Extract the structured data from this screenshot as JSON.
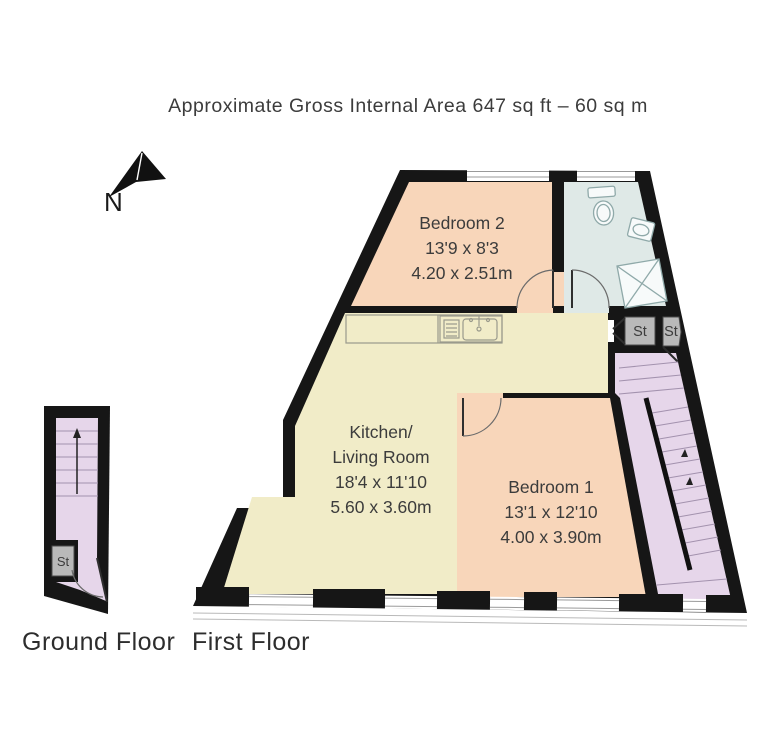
{
  "title": "Approximate Gross Internal Area 647 sq ft – 60 sq m",
  "compass": {
    "label": "N"
  },
  "floor_labels": {
    "ground": "Ground Floor",
    "first": "First Floor"
  },
  "rooms": {
    "bedroom2": {
      "name": "Bedroom 2",
      "dims_imperial": "13'9 x 8'3",
      "dims_metric": "4.20 x 2.51m"
    },
    "kitchen_living": {
      "name_line1": "Kitchen/",
      "name_line2": "Living Room",
      "dims_imperial": "18'4 x 11'10",
      "dims_metric": "5.60 x 3.60m"
    },
    "bedroom1": {
      "name": "Bedroom 1",
      "dims_imperial": "13'1 x 12'10",
      "dims_metric": "4.00 x 3.90m"
    }
  },
  "storage": {
    "abbrev": "St"
  },
  "colors": {
    "wall": "#161616",
    "bedroom": "#f8d6ba",
    "kitchen": "#f1ecc8",
    "bathroom": "#dfe9e7",
    "stairs": "#e6d6ea",
    "storage": "#b9b9b9",
    "fixture": "#8fa9a9",
    "tread": "#a392ae",
    "text": "#3c3c3c"
  }
}
